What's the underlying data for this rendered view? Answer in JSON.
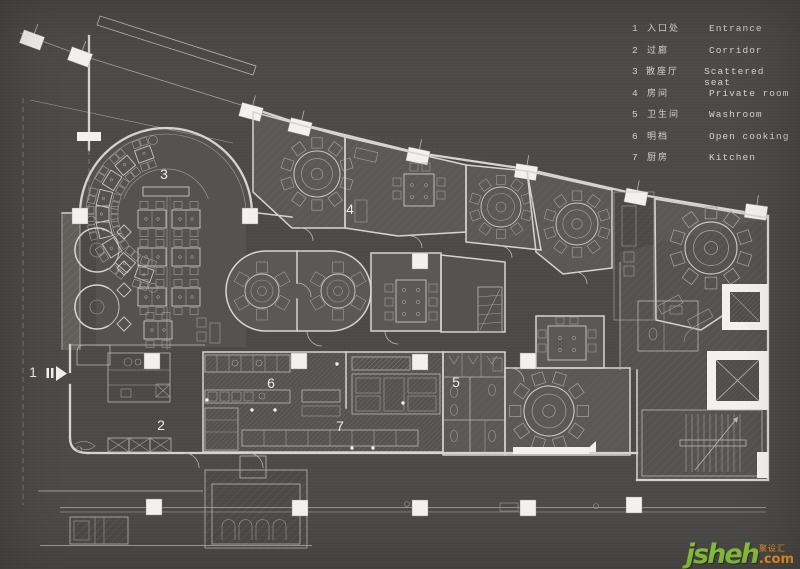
{
  "colors": {
    "bg": "#4b4a47",
    "line": "#d6d4d0",
    "col": "#f2f1ee",
    "wm_green": "#8dc63f",
    "wm_orange": "#f7941d",
    "label": "#ecebe8"
  },
  "legend": {
    "items": [
      {
        "num": "1",
        "zh": "入口处",
        "en": "Entrance"
      },
      {
        "num": "2",
        "zh": "过廊",
        "en": "Corridor"
      },
      {
        "num": "3",
        "zh": "散座厅",
        "en": "Scattered seat"
      },
      {
        "num": "4",
        "zh": "房间",
        "en": "Private room"
      },
      {
        "num": "5",
        "zh": "卫生间",
        "en": "Washroom"
      },
      {
        "num": "6",
        "zh": "明档",
        "en": "Open cooking"
      },
      {
        "num": "7",
        "zh": "厨房",
        "en": "Kitchen"
      }
    ]
  },
  "plan_labels": {
    "entrance": "1",
    "corridor": "2",
    "scattered_seat": "3",
    "private_room": "4",
    "washroom": "5",
    "open_cooking": "6",
    "kitchen": "7"
  },
  "watermark": {
    "brand": "jsheh",
    "zh": "聚设汇",
    "suffix": ".com"
  }
}
